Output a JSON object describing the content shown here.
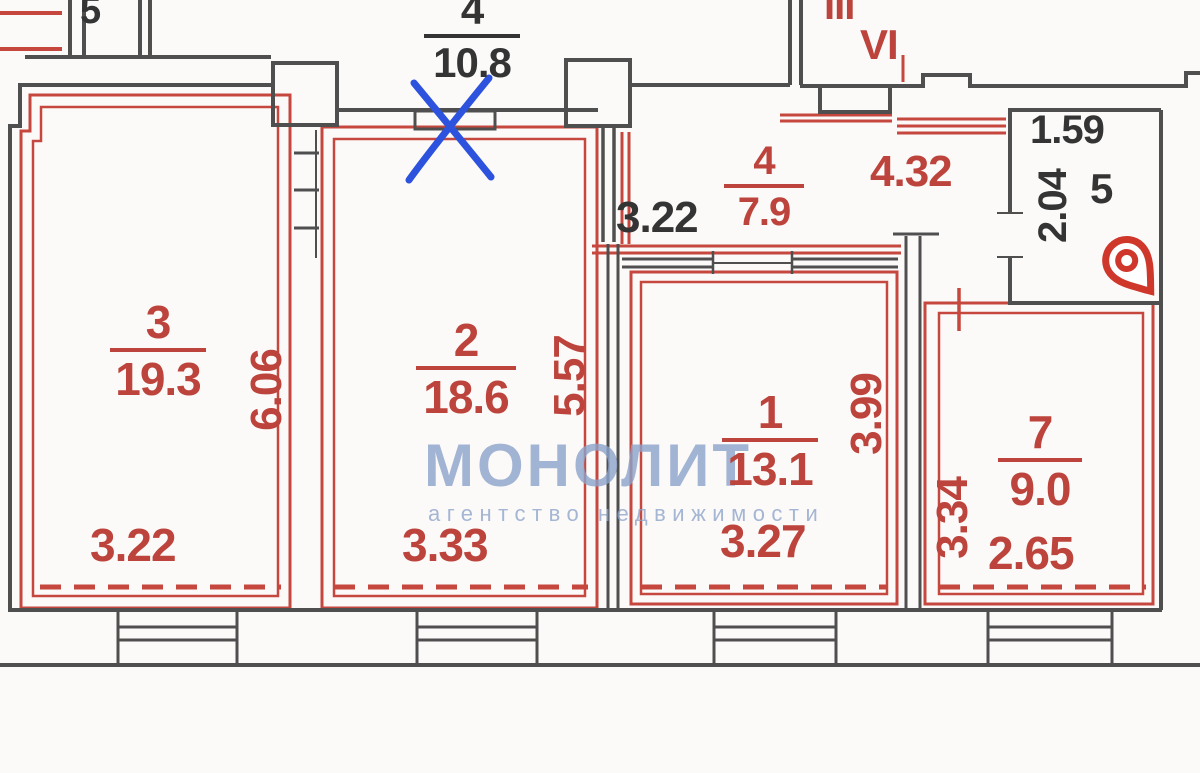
{
  "colors": {
    "wall_dark": "#4f4f4f",
    "wall_red": "#c5473e",
    "dim_red": "#bc443c",
    "text_dark": "#343434",
    "annotation_blue": "#2d53de",
    "pin_red": "#cf372b",
    "watermark_blue": "#8ca3cb",
    "watermark_orange": "#e08a44"
  },
  "plan": {
    "top_left_room": "5",
    "top_center": {
      "number": "4",
      "area": "10.8"
    },
    "stair_label_small": "III",
    "stair_label": "VI",
    "room3": {
      "number": "3",
      "area": "19.3",
      "width": "3.22",
      "depth": "6.06"
    },
    "room2": {
      "number": "2",
      "area": "18.6",
      "width": "3.33",
      "depth": "5.57"
    },
    "corridor": {
      "number": "4",
      "area": "7.9",
      "width_left": "3.22",
      "width_right": "4.32"
    },
    "room1": {
      "number": "1",
      "area": "13.1",
      "width": "3.27",
      "depth": "3.99"
    },
    "room7": {
      "number": "7",
      "area": "9.0",
      "width": "2.65",
      "depth": "3.34"
    },
    "room5": {
      "number": "5",
      "width": "1.59",
      "depth": "2.04"
    }
  },
  "watermark": {
    "title": "МОНОЛИТ",
    "subtitle": "агентство недвижимости"
  }
}
